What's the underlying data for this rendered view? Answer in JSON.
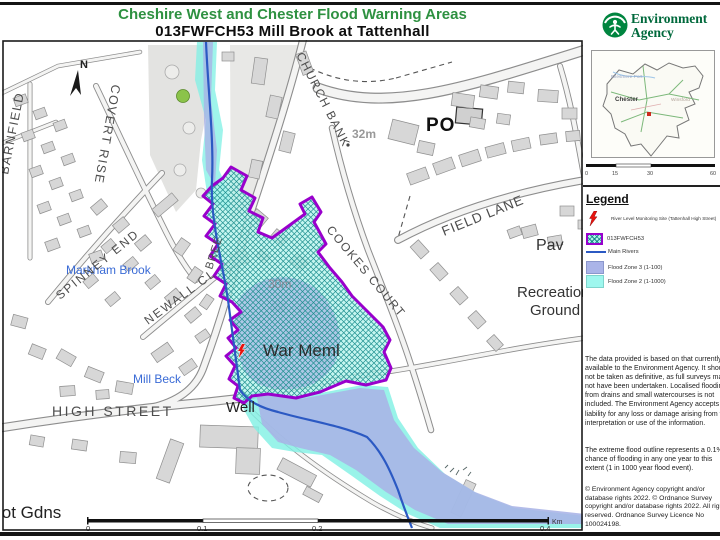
{
  "header": {
    "region_title": "Cheshire West and Chester Flood Warning Areas",
    "area_title": "013FWFCH53 Mill  Brook at Tattenhall"
  },
  "agency": {
    "name_line1": "Environment",
    "name_line2": "Agency"
  },
  "inset": {
    "labels": {
      "ellesmere_port": "Ellesmere Port",
      "chester": "Chester",
      "winsford": "Winsford"
    },
    "scale_ticks": [
      "0",
      "15",
      "30",
      "60"
    ]
  },
  "legend": {
    "heading": "Legend",
    "items": [
      {
        "symbol": "lightning-bolt-icon",
        "label": "River Level Monitoring Site (Tattenhall High Street)"
      },
      {
        "symbol": "flood-warning-area-swatch",
        "label": "013FWFCH53"
      },
      {
        "symbol": "main-river-line",
        "label": "Main Rivers"
      },
      {
        "symbol": "flood-zone-3-swatch",
        "label": "Flood Zone 3 (1-100)"
      },
      {
        "symbol": "flood-zone-2-swatch",
        "label": "Flood Zone 2 (1-1000)"
      }
    ]
  },
  "notes": {
    "disclaimer": "The data provided is based on that currently available to the Environment Agency. It should not be taken as definitive, as full surveys may not have been undertaken. Localised flooding from drains and small watercourses is not included. The Environment Agency accepts no liability for any loss or damage arising from the interpretation or use of the information.",
    "extreme_flood": "The extreme flood outline represents a 0.1% chance of flooding in any one year to this extent (1 in 1000 year flood event).",
    "copyright": "© Environment Agency copyright and/or database rights 2022. © Ordnance Survey copyright and/or database rights 2022. All rights reserved. Ordnance Survey Licence No 100024198."
  },
  "map": {
    "labels": {
      "north": "N",
      "barnfield": "BARNFIELD",
      "covert_rise": "COVERT RISE",
      "church_bank": "CHURCH BANK",
      "spot_height_32": "32m",
      "post_office": "PO",
      "field_lane": "FIELD LANE",
      "cookes_court": "COOKES COURT",
      "pavilion": "Pav",
      "recreation_line1": "Recreation",
      "recreation_line2": "Ground",
      "markham_brook": "Markham Brook",
      "spinney_end": "SPINNEY END",
      "newall_close": "NEWALL CL",
      "bree": "BREE",
      "mill_beck": "Mill Beck",
      "war_memorial": "War Meml",
      "spot_height_30": "30m",
      "well": "Well",
      "allotment_gardens": "lot Gdns",
      "high_street": "HIGH STREET"
    },
    "scalebar": {
      "ticks": [
        "0",
        "0.1",
        "0.2",
        "0.4"
      ],
      "unit": "Km"
    }
  },
  "colors": {
    "title_green": "#2e9141",
    "warning_outline_purple": "#9900cc",
    "warning_fill_cyan": "#aef2ea",
    "flood_zone_3": "#aab4e8",
    "flood_zone_2": "#9ef7ee",
    "main_river_blue": "#2b59c3",
    "monitoring_site_red": "#e8130e",
    "agency_green": "#00853f"
  }
}
